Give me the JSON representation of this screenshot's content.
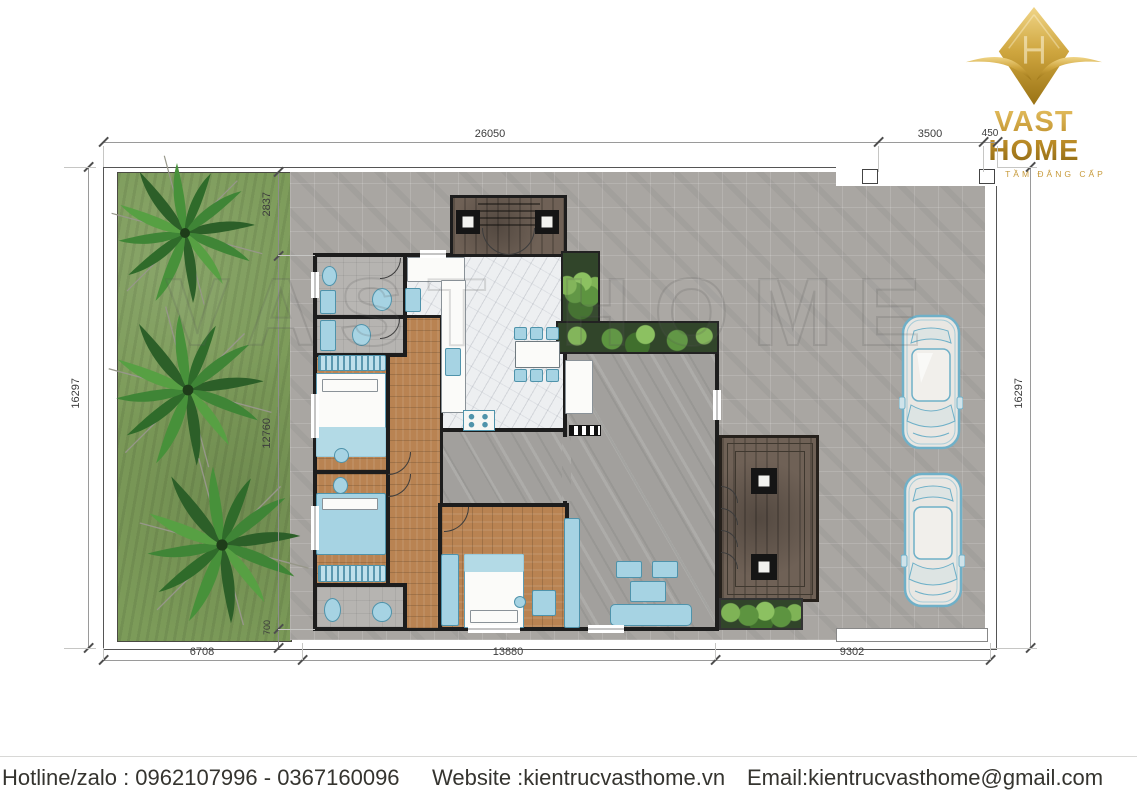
{
  "logo": {
    "title": "VAST HOME",
    "tagline": "XỨNG TẦM ĐẲNG CẤP"
  },
  "watermark": {
    "text": "VAST HOME"
  },
  "dimensions": {
    "top_total": "26050",
    "top_gate": "3500",
    "top_corner": "450",
    "left_height": "16297",
    "right_height": "16297",
    "bottom_left": "6708",
    "bottom_house": "13880",
    "bottom_right": "9302",
    "inner_top": "2837",
    "inner_house": "12760",
    "inner_bottom": "700"
  },
  "footer": {
    "hotline": "Hotline/zalo : 0962107996 - 0367160096",
    "website": "Website :kientrucvasthome.vn",
    "email": "Email:kientrucvasthome@gmail.com"
  },
  "colors": {
    "brand_gold": "#c79a3a",
    "grass_green": "#7c9b59",
    "pavement_gray": "#a9a6a2",
    "wall_black": "#1d1d1d",
    "furniture_blue": "#a6d3e3",
    "wood_tan": "#b98352",
    "deck_brown": "#6f6156"
  }
}
